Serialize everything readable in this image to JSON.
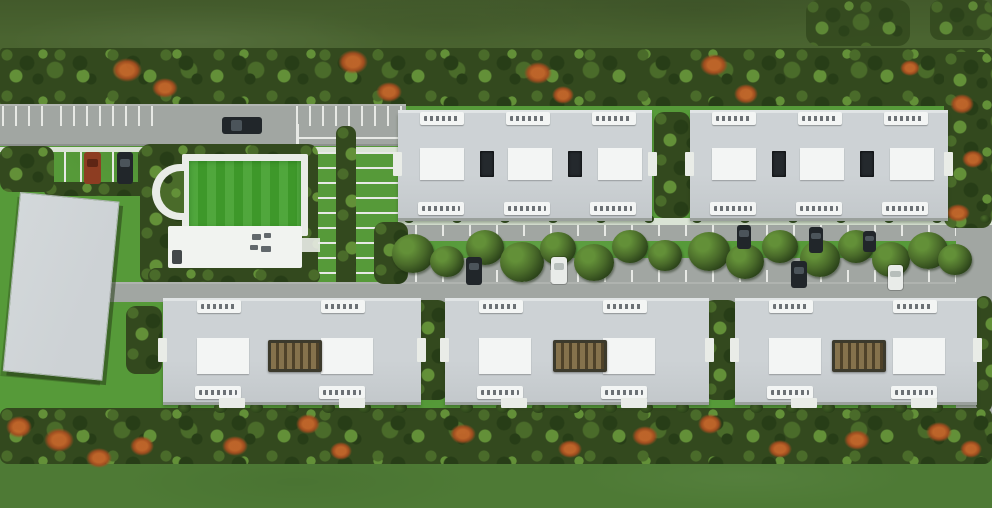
{
  "meta": {
    "title": "Aerial master-plan rendering of a residential complex",
    "view": "top-down site plan"
  },
  "palette": {
    "field_top": "#4a6430",
    "grass": "#569a39",
    "grass_bottom": "#4e7a35",
    "foliage_base": "#33491e",
    "foliage_dark": "#273d17",
    "foliage_mid": "#4a6b2a",
    "foliage_light": "#639038",
    "flower": "#c4662a",
    "flower_dark": "#a34d1f",
    "road": "#a1a6a2",
    "paving": "#c6cac5",
    "stripe": "#e7e9e5",
    "path": "#e9ece7",
    "roof": "#cdd2d5",
    "roof_dark": "#9aa09c",
    "roof_light": "#e0e4e5",
    "white_box": "#f3f5f4",
    "vent": "#24292d",
    "chip_text": "#3f454b",
    "pergola_light": "#85724c",
    "pergola_dark": "#4f4229",
    "car_dark": "#21262a",
    "car_white": "#e9ece9",
    "car_red": "#8d3d22",
    "lawn": "#41a02c",
    "clubhouse": "#f1f3f0"
  },
  "areas": {
    "north_field": "open field",
    "north_tree_line": "tree line with orange flowering trees",
    "entry_road": "entry road with striped parking bays",
    "guest_parking": "guest parking bay",
    "lawn_court": "amenity lawn court",
    "clubhouse": "clubhouse with rooftop equipment",
    "central_parking": "parking court with planted medians",
    "parking_lane": "tree-lined central parking lane",
    "service_building": "large flat-roof service building",
    "apartment_building_top": "apartment block with unit plates and rooftop units",
    "apartment_building_bottom": "apartment block with central pergola",
    "south_tree_line": "tree line with orange flowering trees",
    "south_field": "open field"
  },
  "inventory": {
    "apartment_buildings": 5,
    "top_row_buildings": 2,
    "bottom_row_buildings": 3,
    "unit_label_plates": 24,
    "rooftop_unit_boxes": 12,
    "dark_roof_vents": 4,
    "pergolas": 3,
    "clubhouse_count": 1,
    "service_buildings": 1,
    "lawn_courts": 1,
    "cars_visible": 10
  }
}
